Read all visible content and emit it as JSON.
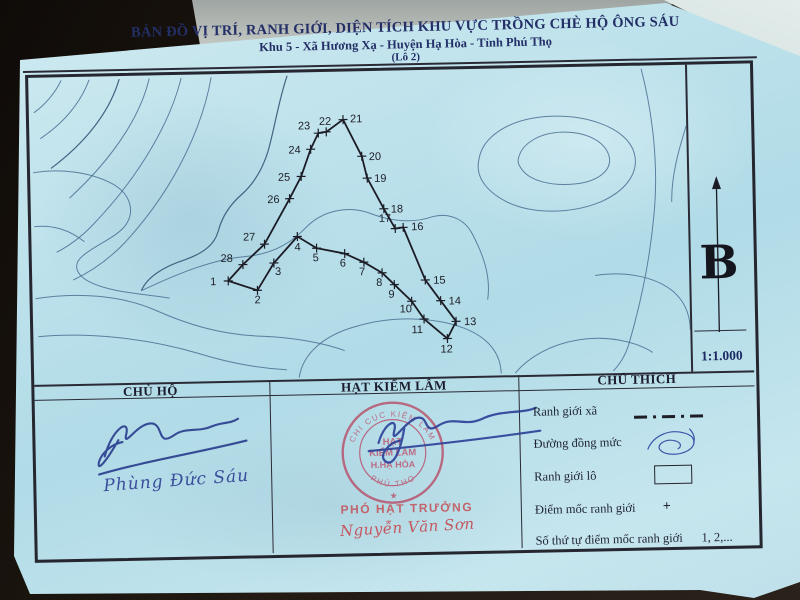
{
  "title": {
    "line1": "BẢN ĐỒ VỊ TRÍ, RANH GIỚI, DIỆN TÍCH KHU VỰC TRỒNG CHÈ HỘ ÔNG SÁU",
    "line2": "Khu 5 - Xã Hương Xạ - Huyện Hạ Hòa - Tỉnh Phú Thọ",
    "line3": "(Lô 2)"
  },
  "map": {
    "north_label": "B",
    "scale_label": "1:1.000",
    "points": [
      {
        "n": "1",
        "x": 193,
        "y": 204,
        "lx": 181,
        "ly": 208,
        "a": "end"
      },
      {
        "n": "2",
        "x": 222,
        "y": 214,
        "lx": 222,
        "ly": 227,
        "a": "middle"
      },
      {
        "n": "3",
        "x": 239,
        "y": 187,
        "lx": 243,
        "ly": 199,
        "a": "middle"
      },
      {
        "n": "4",
        "x": 263,
        "y": 161,
        "lx": 263,
        "ly": 175,
        "a": "middle"
      },
      {
        "n": "5",
        "x": 282,
        "y": 173,
        "lx": 281,
        "ly": 186,
        "a": "middle"
      },
      {
        "n": "6",
        "x": 310,
        "y": 179,
        "lx": 308,
        "ly": 192,
        "a": "middle"
      },
      {
        "n": "7",
        "x": 329,
        "y": 188,
        "lx": 327,
        "ly": 201,
        "a": "middle"
      },
      {
        "n": "8",
        "x": 347,
        "y": 199,
        "lx": 344,
        "ly": 212,
        "a": "middle"
      },
      {
        "n": "9",
        "x": 359,
        "y": 211,
        "lx": 356,
        "ly": 224,
        "a": "middle"
      },
      {
        "n": "10",
        "x": 376,
        "y": 228,
        "lx": 370,
        "ly": 239,
        "a": "middle"
      },
      {
        "n": "11",
        "x": 388,
        "y": 246,
        "lx": 381,
        "ly": 260,
        "a": "middle"
      },
      {
        "n": "12",
        "x": 411,
        "y": 266,
        "lx": 410,
        "ly": 280,
        "a": "middle"
      },
      {
        "n": "13",
        "x": 420,
        "y": 249,
        "lx": 428,
        "ly": 253,
        "a": "start"
      },
      {
        "n": "14",
        "x": 405,
        "y": 228,
        "lx": 413,
        "ly": 232,
        "a": "start"
      },
      {
        "n": "15",
        "x": 390,
        "y": 207,
        "lx": 398,
        "ly": 211,
        "a": "start"
      },
      {
        "n": "16",
        "x": 369,
        "y": 154,
        "lx": 377,
        "ly": 157,
        "a": "start"
      },
      {
        "n": "17",
        "x": 361,
        "y": 155,
        "lx": 357,
        "ly": 148,
        "a": "end"
      },
      {
        "n": "18",
        "x": 350,
        "y": 135,
        "lx": 357,
        "ly": 139,
        "a": "start"
      },
      {
        "n": "19",
        "x": 334,
        "y": 104,
        "lx": 341,
        "ly": 108,
        "a": "start"
      },
      {
        "n": "20",
        "x": 329,
        "y": 82,
        "lx": 336,
        "ly": 86,
        "a": "start"
      },
      {
        "n": "21",
        "x": 311,
        "y": 45,
        "lx": 318,
        "ly": 48,
        "a": "start"
      },
      {
        "n": "22",
        "x": 294,
        "y": 57,
        "lx": 293,
        "ly": 50,
        "a": "middle"
      },
      {
        "n": "23",
        "x": 286,
        "y": 58,
        "lx": 278,
        "ly": 54,
        "a": "end"
      },
      {
        "n": "24",
        "x": 278,
        "y": 74,
        "lx": 268,
        "ly": 78,
        "a": "end"
      },
      {
        "n": "25",
        "x": 268,
        "y": 101,
        "lx": 257,
        "ly": 105,
        "a": "end"
      },
      {
        "n": "26",
        "x": 256,
        "y": 123,
        "lx": 246,
        "ly": 127,
        "a": "end"
      },
      {
        "n": "27",
        "x": 230,
        "y": 168,
        "lx": 221,
        "ly": 164,
        "a": "end"
      },
      {
        "n": "28",
        "x": 208,
        "y": 188,
        "lx": 198,
        "ly": 185,
        "a": "end"
      }
    ],
    "contours": [
      "M30 0 C24 12 14 24 2 32",
      "M58 0 C50 20 36 40 8 58",
      "M88 0 C80 26 60 58 18 88",
      "M118 0 C110 32 86 74 36 118",
      "M150 0 C140 38 112 92 58 146 C46 158 34 166 22 172",
      "M180 0 C172 42 146 106 90 164 C74 180 56 192 38 200",
      "M0 92 C26 88 56 92 78 104 C98 115 102 134 90 148 C80 159 60 166 48 176 C38 184 40 194 54 202 C74 213 106 215 134 220",
      "M0 146 C18 144 36 150 50 162",
      "M0 218 C40 212 86 216 120 232 C150 246 184 258 226 260 C258 262 288 268 308 276",
      "M2 256 C52 252 112 260 162 276 C192 286 222 292 250 294",
      "M256 0 C248 22 244 44 238 66 C232 90 222 106 208 118 C196 128 188 140 184 154 C180 168 168 176 150 182 C130 188 112 198 106 212",
      "M106 212 C142 196 178 182 210 180 C240 178 258 166 272 152 C288 136 314 130 338 140 C358 148 380 150 398 144 C414 140 430 146 438 162 C448 182 456 204 452 228",
      "M446 88 C450 64 478 48 514 46 C554 44 590 58 600 80 C608 100 596 120 568 132 C538 144 498 144 472 130 C452 119 442 104 446 88 Z",
      "M486 86 C490 72 508 62 530 62 C554 62 572 72 576 86 C580 100 566 112 542 114 C518 116 498 110 490 100 C486 95 484 91 486 86 Z",
      "M610 0 C620 42 626 94 620 146 C615 192 604 238 592 276 C588 288 582 296 576 302",
      "M654 58 C646 82 638 108 638 134",
      "M560 206 C590 202 618 208 636 222 C648 232 654 246 654 262",
      "M262 302 C266 278 288 260 320 252 C356 242 398 244 428 256 C452 266 464 282 464 302",
      "M478 302 C492 286 514 274 542 270 C570 266 598 272 616 284"
    ]
  },
  "table": {
    "col1_header": "CHỦ HỘ",
    "col2_header": "HẠT KIỂM LÂM",
    "col3_header": "CHÚ THÍCH"
  },
  "legend": {
    "items": [
      {
        "label": "Ranh giới xã",
        "symbol": "dashdot",
        "symbol_text": ""
      },
      {
        "label": "Đường đồng mức",
        "symbol": "contour",
        "symbol_text": ""
      },
      {
        "label": "Ranh giới lô",
        "symbol": "rect",
        "symbol_text": ""
      },
      {
        "label": "Điểm mốc ranh giới",
        "symbol": "plus",
        "symbol_text": "+"
      },
      {
        "label": "Số thứ tự điểm mốc ranh giới",
        "symbol": "text",
        "symbol_text": "1, 2,..."
      }
    ]
  },
  "signatures": {
    "owner_name": "Phùng Đức Sáu",
    "forest_title": "PHÓ HẠT TRƯỞNG",
    "forest_name": "Nguyễn Văn Sơn",
    "stamp": {
      "rim_top": "CHI CỤC KIỂM LÂM",
      "rim_bottom": "PHÚ THỌ",
      "star": "★",
      "line1": "HẠT",
      "line2": "KIỂM LÂM",
      "line3": "H.HẠ HÒA"
    }
  },
  "colors": {
    "paper": "#bee2ec",
    "print": "#23232e",
    "title_navy": "#232f66",
    "contour_blue": "#4a6e92",
    "ink_blue": "#2b3f8f",
    "stamp_red": "#bc5570"
  }
}
